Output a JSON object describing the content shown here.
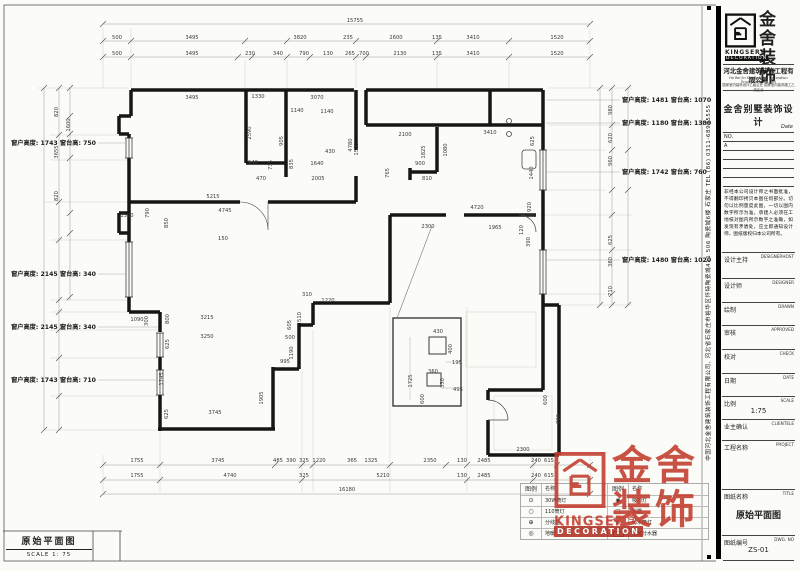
{
  "plan": {
    "title": "原始平面图",
    "scale_label": "SCALE 1: 75",
    "window_annotations_left": [
      {
        "y": 143,
        "t": "窗户高度: 1743 窗台高: 750"
      },
      {
        "y": 274,
        "t": "窗户高度: 2145 窗台高: 340"
      },
      {
        "y": 327,
        "t": "窗户高度: 2145 窗台高: 340"
      },
      {
        "y": 380,
        "t": "窗户高度: 1743 窗台高: 710"
      }
    ],
    "window_annotations_right": [
      {
        "y": 100,
        "t": "窗户高度: 1481 窗台高: 1070"
      },
      {
        "y": 123,
        "t": "窗户高度: 1180 窗台高: 1380"
      },
      {
        "y": 172,
        "t": "窗户高度: 1742 窗台高: 760"
      },
      {
        "y": 260,
        "t": "窗户高度: 1480 窗台高: 1020"
      }
    ],
    "labels": [
      {
        "x": 355,
        "y": 22,
        "t": "15755"
      },
      {
        "x": 117,
        "y": 39,
        "t": "500"
      },
      {
        "x": 192,
        "y": 39,
        "t": "3495"
      },
      {
        "x": 300,
        "y": 39,
        "t": "3820"
      },
      {
        "x": 348,
        "y": 39,
        "t": "235"
      },
      {
        "x": 396,
        "y": 39,
        "t": "2600"
      },
      {
        "x": 437,
        "y": 39,
        "t": "135"
      },
      {
        "x": 473,
        "y": 39,
        "t": "3410"
      },
      {
        "x": 557,
        "y": 39,
        "t": "1520"
      },
      {
        "x": 117,
        "y": 55,
        "t": "500"
      },
      {
        "x": 192,
        "y": 55,
        "t": "3495"
      },
      {
        "x": 250,
        "y": 55,
        "t": "230"
      },
      {
        "x": 278,
        "y": 55,
        "t": "340"
      },
      {
        "x": 304,
        "y": 55,
        "t": "790"
      },
      {
        "x": 328,
        "y": 55,
        "t": "130"
      },
      {
        "x": 350,
        "y": 55,
        "t": "265"
      },
      {
        "x": 364,
        "y": 55,
        "t": "700"
      },
      {
        "x": 400,
        "y": 55,
        "t": "2130"
      },
      {
        "x": 437,
        "y": 55,
        "t": "135"
      },
      {
        "x": 473,
        "y": 55,
        "t": "3410"
      },
      {
        "x": 557,
        "y": 55,
        "t": "1520"
      },
      {
        "x": 137,
        "y": 462,
        "t": "1755"
      },
      {
        "x": 218,
        "y": 462,
        "t": "3745"
      },
      {
        "x": 278,
        "y": 462,
        "t": "485"
      },
      {
        "x": 291,
        "y": 462,
        "t": "390"
      },
      {
        "x": 304,
        "y": 462,
        "t": "325"
      },
      {
        "x": 319,
        "y": 462,
        "t": "1220"
      },
      {
        "x": 352,
        "y": 462,
        "t": "365"
      },
      {
        "x": 371,
        "y": 462,
        "t": "1325"
      },
      {
        "x": 430,
        "y": 462,
        "t": "2350"
      },
      {
        "x": 462,
        "y": 462,
        "t": "130"
      },
      {
        "x": 484,
        "y": 462,
        "t": "2485"
      },
      {
        "x": 536,
        "y": 462,
        "t": "240"
      },
      {
        "x": 549,
        "y": 462,
        "t": "615"
      },
      {
        "x": 137,
        "y": 477,
        "t": "1755"
      },
      {
        "x": 230,
        "y": 477,
        "t": "4740"
      },
      {
        "x": 304,
        "y": 477,
        "t": "325"
      },
      {
        "x": 383,
        "y": 477,
        "t": "5210"
      },
      {
        "x": 462,
        "y": 477,
        "t": "130"
      },
      {
        "x": 484,
        "y": 477,
        "t": "2485"
      },
      {
        "x": 536,
        "y": 477,
        "t": "240"
      },
      {
        "x": 549,
        "y": 477,
        "t": "615"
      },
      {
        "x": 347,
        "y": 491,
        "t": "16180"
      },
      {
        "x": 58,
        "y": 112,
        "t": "820",
        "r": 1
      },
      {
        "x": 58,
        "y": 152,
        "t": "3655",
        "r": 1
      },
      {
        "x": 58,
        "y": 196,
        "t": "820",
        "r": 1
      },
      {
        "x": 70,
        "y": 125,
        "t": "1600",
        "r": 1
      },
      {
        "x": 612,
        "y": 110,
        "t": "980",
        "r": 1
      },
      {
        "x": 612,
        "y": 138,
        "t": "620",
        "r": 1
      },
      {
        "x": 612,
        "y": 161,
        "t": "960",
        "r": 1
      },
      {
        "x": 612,
        "y": 240,
        "t": "625",
        "r": 1
      },
      {
        "x": 612,
        "y": 262,
        "t": "380",
        "r": 1
      },
      {
        "x": 612,
        "y": 291,
        "t": "710",
        "r": 1
      },
      {
        "x": 192,
        "y": 99,
        "t": "3495"
      },
      {
        "x": 258,
        "y": 98,
        "t": "1330"
      },
      {
        "x": 317,
        "y": 99,
        "t": "3070"
      },
      {
        "x": 297,
        "y": 112,
        "t": "1140"
      },
      {
        "x": 327,
        "y": 113,
        "t": "1140"
      },
      {
        "x": 251,
        "y": 133,
        "t": "2590",
        "r": 1
      },
      {
        "x": 283,
        "y": 141,
        "t": "905",
        "r": 1
      },
      {
        "x": 352,
        "y": 145,
        "t": "4780",
        "r": 1
      },
      {
        "x": 253,
        "y": 164,
        "t": "540"
      },
      {
        "x": 261,
        "y": 180,
        "t": "470"
      },
      {
        "x": 272,
        "y": 165,
        "t": "735",
        "r": 1
      },
      {
        "x": 293,
        "y": 164,
        "t": "835",
        "r": 1
      },
      {
        "x": 317,
        "y": 165,
        "t": "1640"
      },
      {
        "x": 330,
        "y": 153,
        "t": "430"
      },
      {
        "x": 358,
        "y": 149,
        "t": "1525",
        "r": 1
      },
      {
        "x": 318,
        "y": 180,
        "t": "2005"
      },
      {
        "x": 405,
        "y": 136,
        "t": "2100"
      },
      {
        "x": 425,
        "y": 152,
        "t": "1825",
        "r": 1
      },
      {
        "x": 447,
        "y": 150,
        "t": "1080",
        "r": 1
      },
      {
        "x": 420,
        "y": 165,
        "t": "900"
      },
      {
        "x": 427,
        "y": 180,
        "t": "810"
      },
      {
        "x": 389,
        "y": 173,
        "t": "765",
        "r": 1
      },
      {
        "x": 490,
        "y": 134,
        "t": "3410"
      },
      {
        "x": 534,
        "y": 141,
        "t": "625",
        "r": 1
      },
      {
        "x": 533,
        "y": 173,
        "t": "1440",
        "r": 1
      },
      {
        "x": 531,
        "y": 207,
        "t": "920",
        "r": 1
      },
      {
        "x": 477,
        "y": 209,
        "t": "4720"
      },
      {
        "x": 428,
        "y": 228,
        "t": "2300"
      },
      {
        "x": 495,
        "y": 229,
        "t": "1965"
      },
      {
        "x": 523,
        "y": 230,
        "t": "120",
        "r": 1
      },
      {
        "x": 530,
        "y": 242,
        "t": "390",
        "r": 1
      },
      {
        "x": 213,
        "y": 198,
        "t": "5215"
      },
      {
        "x": 225,
        "y": 212,
        "t": "4745"
      },
      {
        "x": 127,
        "y": 217,
        "t": "1500"
      },
      {
        "x": 149,
        "y": 213,
        "t": "790",
        "r": 1
      },
      {
        "x": 168,
        "y": 223,
        "t": "850",
        "r": 1
      },
      {
        "x": 223,
        "y": 240,
        "t": "150"
      },
      {
        "x": 137,
        "y": 321,
        "t": "1090"
      },
      {
        "x": 148,
        "y": 321,
        "t": "300",
        "r": 1
      },
      {
        "x": 169,
        "y": 319,
        "t": "800",
        "r": 1
      },
      {
        "x": 207,
        "y": 319,
        "t": "3215"
      },
      {
        "x": 207,
        "y": 338,
        "t": "3250"
      },
      {
        "x": 169,
        "y": 344,
        "t": "625",
        "r": 1
      },
      {
        "x": 163,
        "y": 379,
        "t": "1745",
        "r": 1
      },
      {
        "x": 168,
        "y": 414,
        "t": "625",
        "r": 1
      },
      {
        "x": 215,
        "y": 414,
        "t": "3745"
      },
      {
        "x": 263,
        "y": 398,
        "t": "1905",
        "r": 1
      },
      {
        "x": 285,
        "y": 363,
        "t": "995"
      },
      {
        "x": 293,
        "y": 353,
        "t": "1190",
        "r": 1
      },
      {
        "x": 290,
        "y": 339,
        "t": "500"
      },
      {
        "x": 307,
        "y": 296,
        "t": "310"
      },
      {
        "x": 328,
        "y": 302,
        "t": "1220"
      },
      {
        "x": 291,
        "y": 325,
        "t": "605",
        "r": 1
      },
      {
        "x": 301,
        "y": 317,
        "t": "510",
        "r": 1
      },
      {
        "x": 523,
        "y": 451,
        "t": "2300"
      },
      {
        "x": 560,
        "y": 419,
        "t": "720",
        "r": 1
      },
      {
        "x": 547,
        "y": 400,
        "t": "600",
        "r": 1
      },
      {
        "x": 438,
        "y": 333,
        "t": "430"
      },
      {
        "x": 452,
        "y": 349,
        "t": "400",
        "r": 1
      },
      {
        "x": 457,
        "y": 364,
        "t": "195"
      },
      {
        "x": 433,
        "y": 373,
        "t": "360"
      },
      {
        "x": 444,
        "y": 383,
        "t": "330",
        "r": 1
      },
      {
        "x": 458,
        "y": 391,
        "t": "495"
      },
      {
        "x": 412,
        "y": 381,
        "t": "1725",
        "r": 1
      },
      {
        "x": 424,
        "y": 399,
        "t": "600",
        "r": 1
      }
    ]
  },
  "legend": {
    "headers": [
      "图例",
      "名称",
      "图例",
      "名称"
    ],
    "rows": [
      {
        "s1": "⊙",
        "n1": "30W筒灯",
        "s2": "◉",
        "n2": "吸顶灯"
      },
      {
        "s1": "○",
        "n1": "110筒灯",
        "s2": "□",
        "n2": "浴霸"
      },
      {
        "s1": "⊕",
        "n1": "分线盒",
        "s2": "⊗",
        "n2": "防水筒灯"
      },
      {
        "s1": "◎",
        "n1": "地暖",
        "s2": "rect",
        "n2": "地暖分水器"
      }
    ]
  },
  "watermark": {
    "cn1": "金舍",
    "cn2": "装饰",
    "en1": "KINGSER",
    "reg": "®",
    "en2": "DECORATION"
  },
  "titleblock": {
    "logo_cn1": "金舍",
    "logo_cn2": "装饰",
    "logo_en1": "KINGSER®",
    "logo_en2": "DECORATION",
    "company_cn": "河北金舍建筑装饰工程有限公司",
    "company_en": "He Bei Jin She Building Decoration Engineering Co., Ltd",
    "cert_line": "国家室内装饰设计乙级企业 国家室内装饰施工乙级企业",
    "project_title": "金舍别墅装饰设计",
    "date_label": "Date",
    "no_label": "NO.",
    "rev_a": "A",
    "disclaimer": "非经本公司设计师之书面批准，不得翻印拷贝本图任何部分。切勿以比例量度此图，一切以图内数字所示为准，承建人必须在工地核对图内所示数字之准确，如发现有矛盾处，应立即通知设计师，图纸版权归本公司所有。",
    "fields": [
      {
        "cn": "设计主持",
        "en": "DESIGNERHOST",
        "value": "",
        "h": 25
      },
      {
        "cn": "设计师",
        "en": "DESIGNER",
        "value": "",
        "h": 23
      },
      {
        "cn": "绘制",
        "en": "DRAWN",
        "value": "",
        "h": 22
      },
      {
        "cn": "审核",
        "en": "APPROVED",
        "value": "",
        "h": 23
      },
      {
        "cn": "校对",
        "en": "CHECK",
        "value": "",
        "h": 23
      },
      {
        "cn": "日期",
        "en": "DATE",
        "value": "",
        "h": 22
      },
      {
        "cn": "比例",
        "en": "SCALE",
        "value": "1:75",
        "h": 22
      },
      {
        "cn": "业主确认",
        "en": "CLIENTELE",
        "value": "",
        "h": 20
      },
      {
        "cn": "工程名称",
        "en": "PROJECT",
        "value": "",
        "h": 48
      },
      {
        "cn": "图纸名称",
        "en": "TITLE",
        "value": "原始平面图",
        "h": 45
      },
      {
        "cn": "图纸编号",
        "en": "DWG. NO",
        "value": "ZS-01",
        "h": 35
      }
    ],
    "side_text": "中国河北金舍建筑装饰工程有限公司, 河北省石家庄市裕华区怀特陶瓷城411 506 陶瓷城6楼 石家庄 TEL (86) 0311-68995555"
  }
}
